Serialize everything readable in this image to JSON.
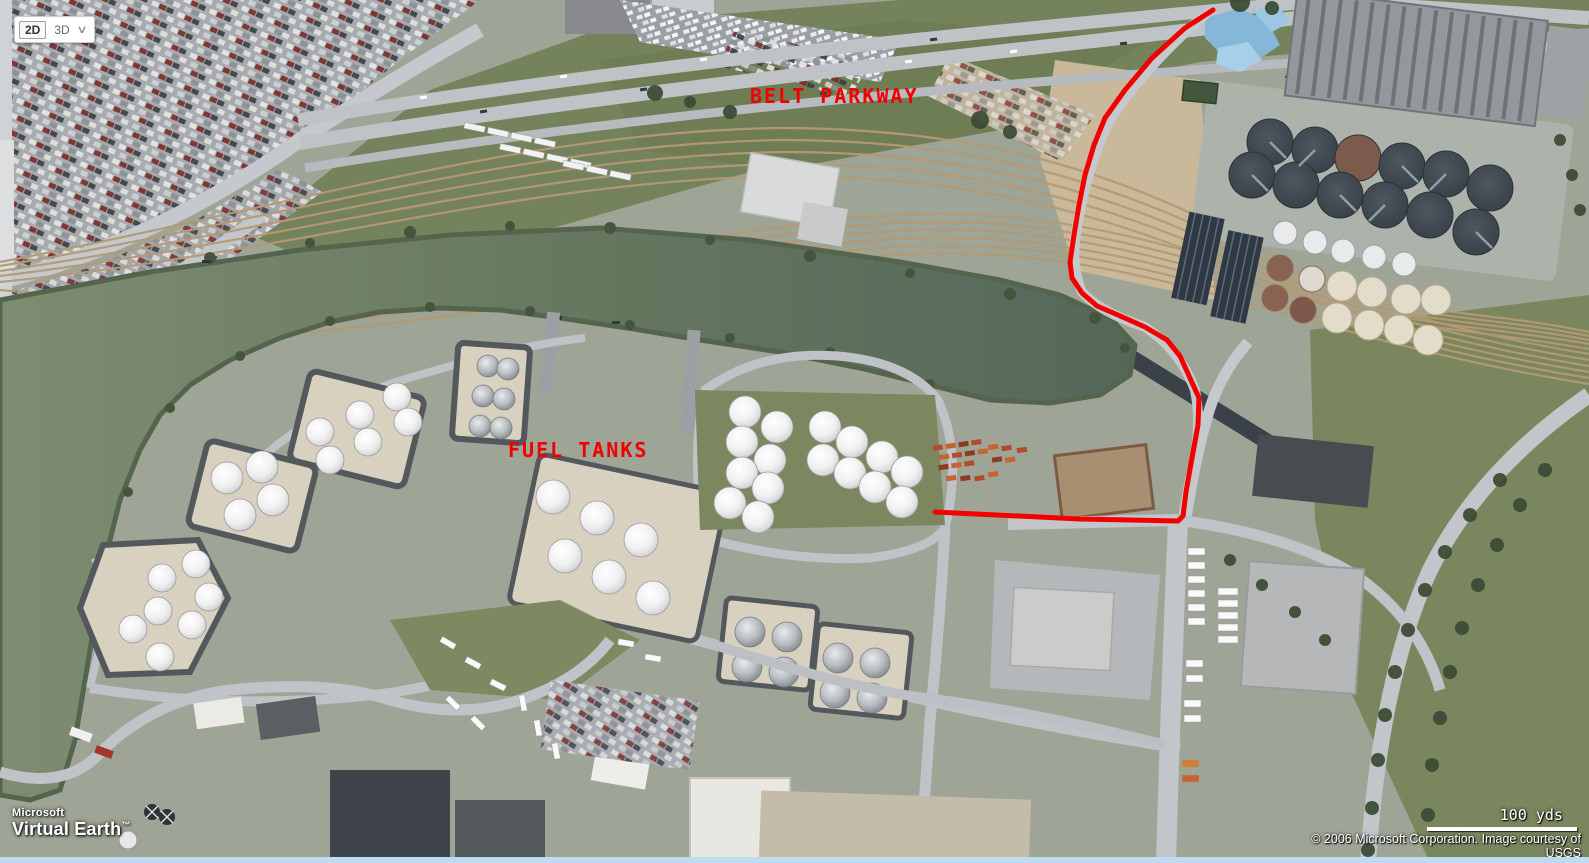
{
  "app": {
    "name": "Microsoft Virtual Earth"
  },
  "view_controls": {
    "view_2d_label": "2D",
    "view_3d_label": "3D",
    "dropdown_glyph": "∨"
  },
  "logo": {
    "brand": "Microsoft",
    "product": "Virtual Earth",
    "trademark": "™"
  },
  "scale_bar": {
    "label": "100 yds"
  },
  "attribution": {
    "line1": "© 2006 Microsoft Corporation. Image courtesy of",
    "line2": "USGS"
  },
  "annotations": {
    "color": "#f20000",
    "belt_parkway_label": "BELT PARKWAY",
    "fuel_tanks_label": "FUEL TANKS",
    "route_points": "1213,10 1185,28 1152,58 1125,90 1105,118 1094,145 1085,175 1079,205 1074,235 1070,262 1072,278 1082,293 1097,306 1118,315 1145,327 1167,340 1180,356 1190,378 1199,398 1198,425 1192,458 1186,492 1183,516 1178,521 1080,519 935,512"
  },
  "map_colors": {
    "water": "#64765f",
    "grass": "#75835c",
    "road": "#c0c4c8",
    "rail": "#b59a74",
    "tank_pad": "#d8d1bf",
    "containment_berm": "#53585c",
    "clarifier_dark": "#3a434b",
    "annotation_red": "#f20000"
  }
}
